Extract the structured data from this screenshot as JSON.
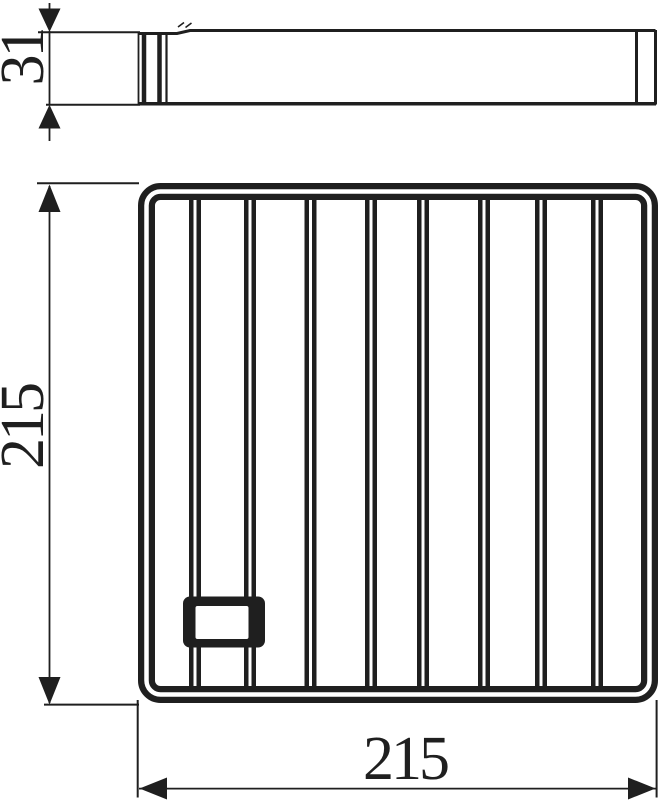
{
  "diagram": {
    "description": "technical-dimension-drawing",
    "colors": {
      "ink": "#1f1f1f",
      "background": "#ffffff"
    },
    "dimension_labels": {
      "side_height": "31",
      "front_height": "215",
      "front_width": "215"
    }
  }
}
